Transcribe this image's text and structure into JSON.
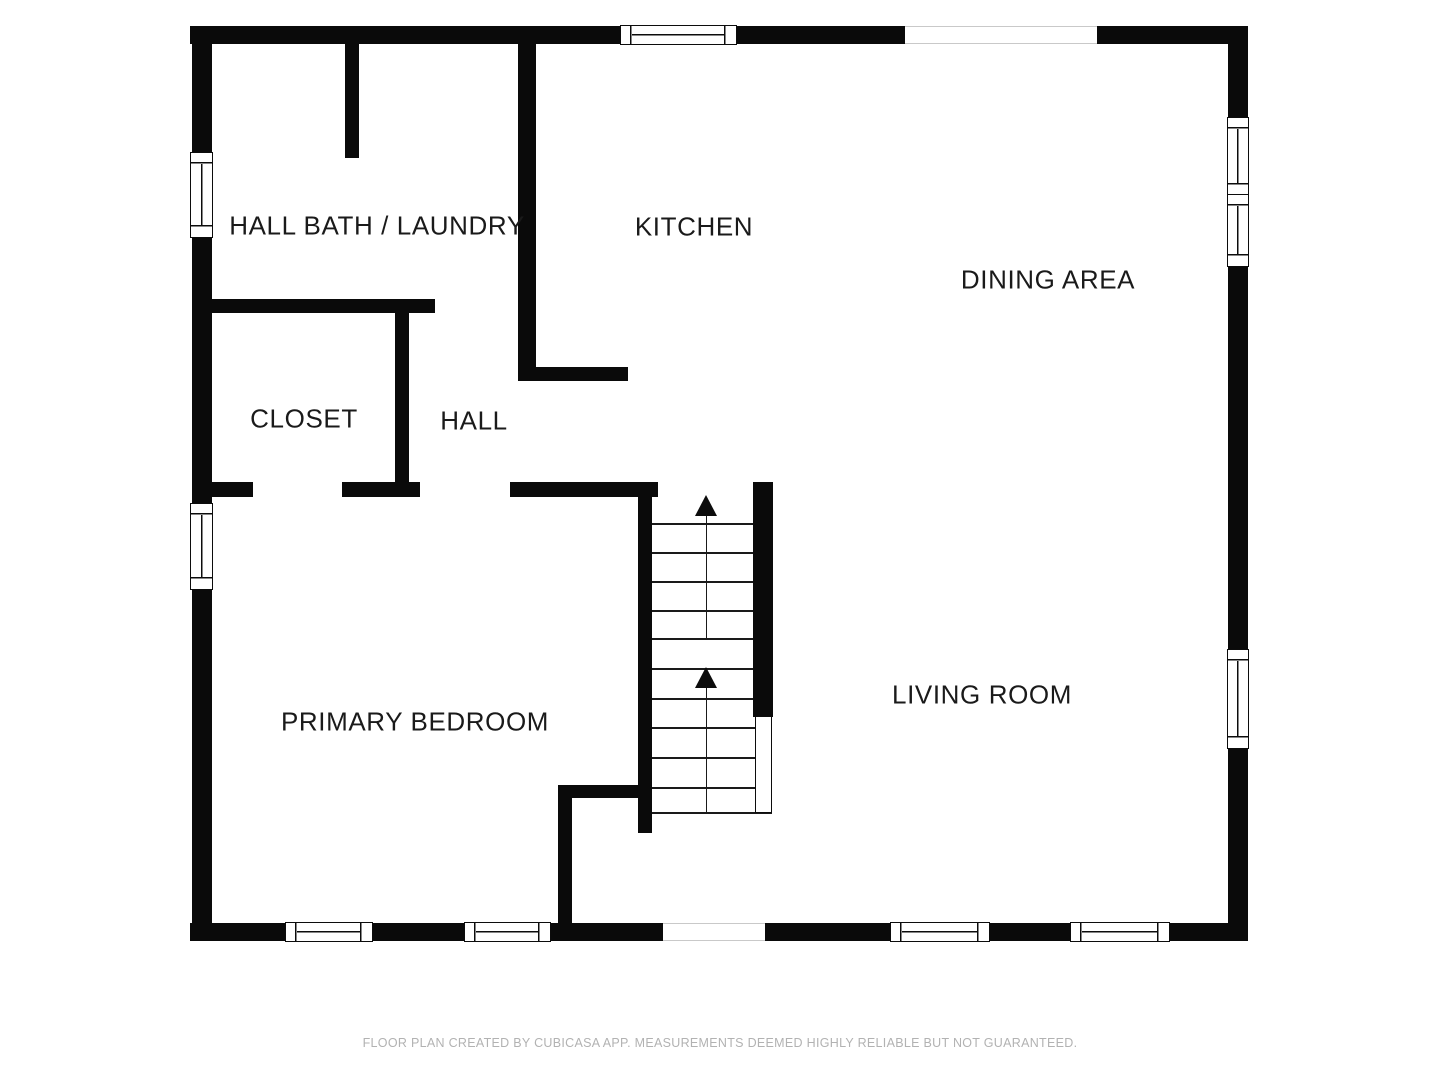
{
  "page": {
    "background": "#ffffff"
  },
  "rooms": [
    {
      "name": "hall-bath-laundry",
      "label": "HALL BATH / LAUNDRY"
    },
    {
      "name": "kitchen",
      "label": "KITCHEN"
    },
    {
      "name": "dining-area",
      "label": "DINING AREA"
    },
    {
      "name": "closet",
      "label": "CLOSET"
    },
    {
      "name": "hall",
      "label": "HALL"
    },
    {
      "name": "primary-bedroom",
      "label": "PRIMARY BEDROOM"
    },
    {
      "name": "living-room",
      "label": "LIVING ROOM"
    }
  ],
  "stairs": {
    "flights": 2,
    "direction": "up",
    "arrows": 2
  },
  "footer": {
    "text": "FLOOR PLAN CREATED BY CUBICASA APP. MEASUREMENTS DEEMED HIGHLY RELIABLE BUT NOT GUARANTEED."
  },
  "colors": {
    "wall": "#0a0a0a",
    "label": "#1a1a1a",
    "footer": "#b2b2b2",
    "background": "#ffffff"
  }
}
